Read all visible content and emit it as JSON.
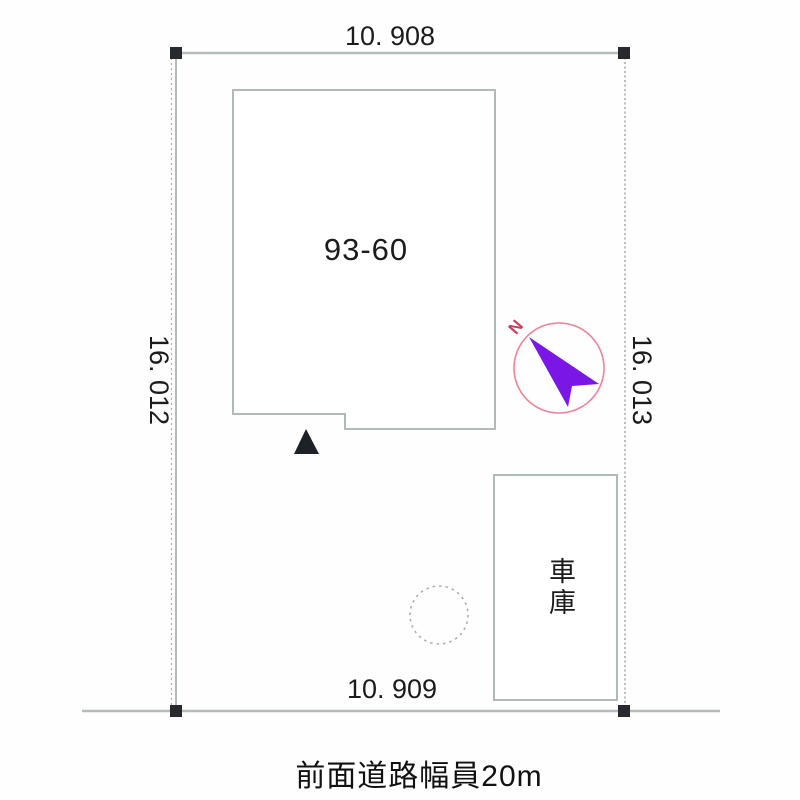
{
  "plan": {
    "parcel_label": "93-60",
    "garage_label": "車庫",
    "north_label": "N",
    "road_caption": "前面道路幅員20m",
    "dimensions": {
      "top": "10. 908",
      "bottom": "10. 909",
      "left": "16. 012",
      "right": "16. 013"
    },
    "colors": {
      "line_gray": "#b3bcb8",
      "boundary_dotted_gray": "#a9b2ae",
      "marker_black": "#26292e",
      "compass_circle_pink": "#f08398",
      "north_arrow_purple": "#7a16e6",
      "north_letter_red": "#d23b5e",
      "text_black": "#1c1c1c"
    }
  }
}
